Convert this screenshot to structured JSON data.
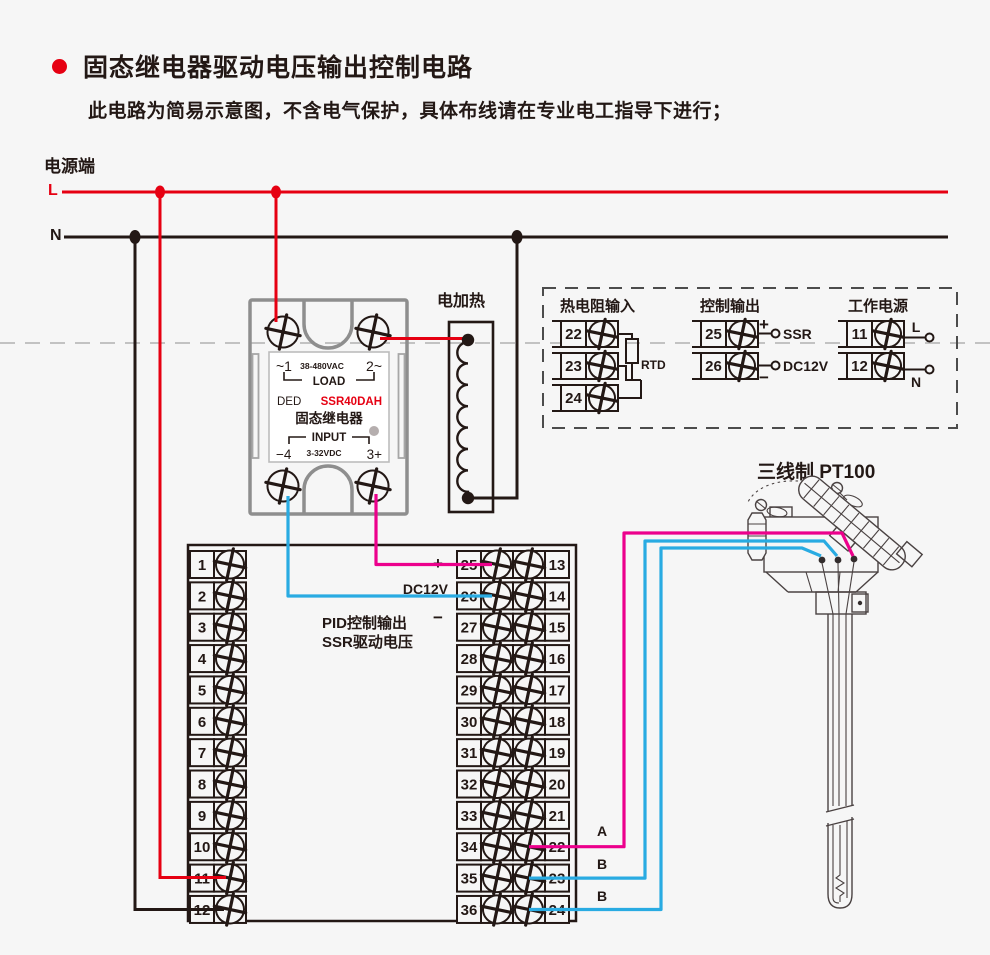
{
  "title": "固态继电器驱动电压输出控制电路",
  "subtitle": "此电路为简易示意图，不含电气保护，具体布线请在专业电工指导下进行；",
  "power": {
    "label": "电源端",
    "l": "L",
    "n": "N"
  },
  "ssr": {
    "t1": "~1",
    "vac": "38-480VAC",
    "t2": "2~",
    "load": "LOAD",
    "brand": "DED",
    "model": "SSR40DAH",
    "name": "固态继电器",
    "input": "INPUT",
    "in_l": "−4",
    "vdc": "3-32VDC",
    "in_r": "3+"
  },
  "heater": {
    "label": "电加热"
  },
  "panel": {
    "rtd": {
      "title": "热电阻输入",
      "terminals": [
        "22",
        "23",
        "24"
      ],
      "rtd_label": "RTD"
    },
    "ctrl": {
      "title": "控制输出",
      "terminals": [
        "25",
        "26"
      ],
      "plus": "+",
      "minus": "−",
      "ssr_label": "SSR",
      "dc12v": "DC12V"
    },
    "supply": {
      "title": "工作电源",
      "terminals": [
        "11",
        "12"
      ],
      "l": "L",
      "n": "N"
    }
  },
  "sensor": {
    "label": "三线制 PT100"
  },
  "block": {
    "left": [
      "1",
      "2",
      "3",
      "4",
      "5",
      "6",
      "7",
      "8",
      "9",
      "10",
      "11",
      "12"
    ],
    "mid": [
      "25",
      "26",
      "27",
      "28",
      "29",
      "30",
      "31",
      "32",
      "33",
      "34",
      "35",
      "36"
    ],
    "right": [
      "13",
      "14",
      "15",
      "16",
      "17",
      "18",
      "19",
      "20",
      "21",
      "22",
      "23",
      "24"
    ],
    "plus": "+",
    "dc12v": "DC12V",
    "minus": "−",
    "pid_line1": "PID控制输出",
    "pid_line2": "SSR驱动电压",
    "wire_a": "A",
    "wire_b1": "B",
    "wire_b2": "B"
  },
  "colors": {
    "line_red": "#e60012",
    "line_black": "#231815",
    "wire_magenta": "#ec008c",
    "wire_blue": "#29abe2",
    "ssr_gray": "#8e8e8e",
    "model_red": "#e60012",
    "background": "#f6f6f6"
  }
}
